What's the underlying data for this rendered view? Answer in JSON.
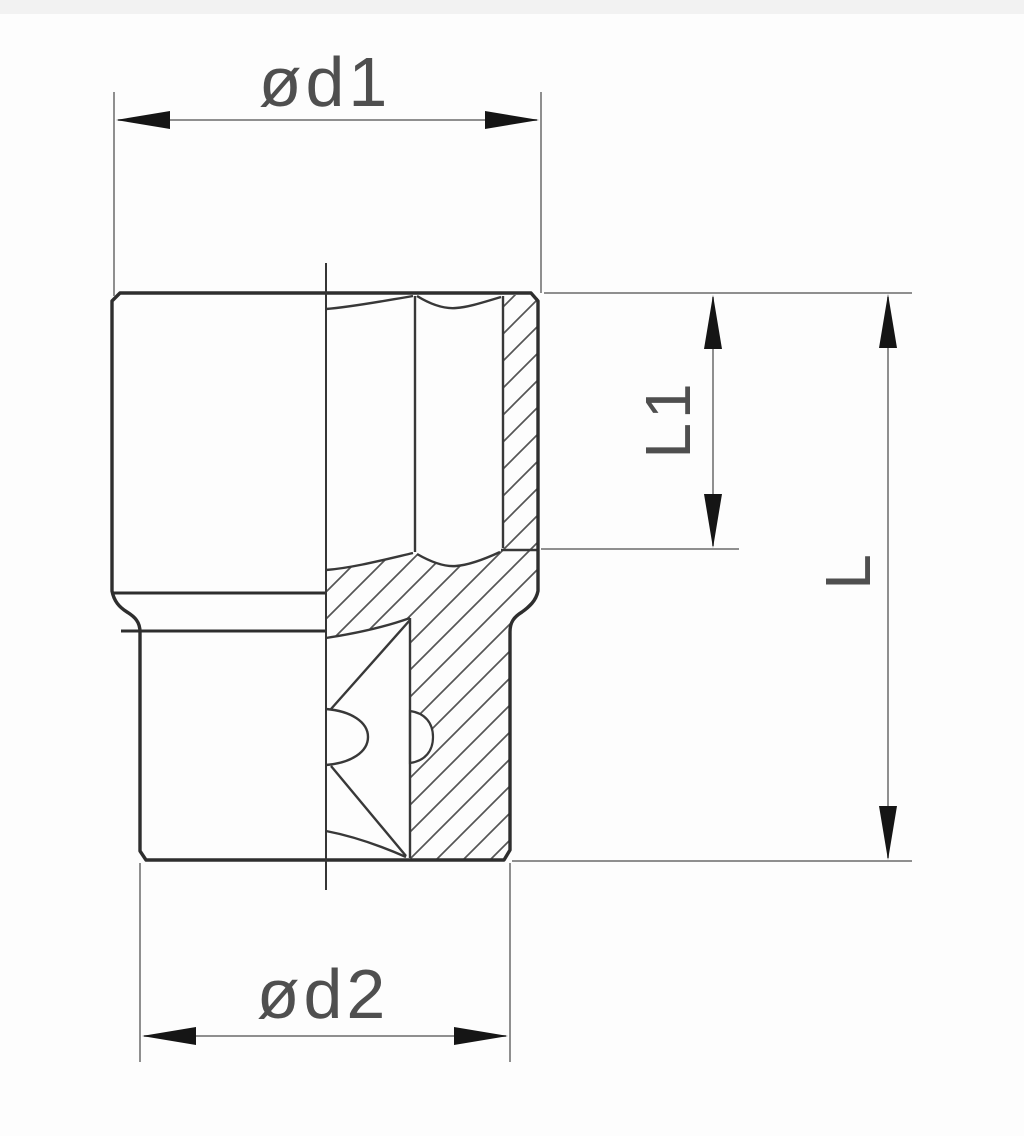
{
  "page": {
    "background": "#fdfdfd",
    "artifact_band_color": "#f2f2f2"
  },
  "drawing": {
    "view": "half-section",
    "colors": {
      "outline": "#2e2e2e",
      "edge": "#383838",
      "hatch": "#555555",
      "dimension_line": "#8f8f8f",
      "arrow": "#151515",
      "label_text": "#4f4f4f"
    },
    "labels": {
      "d1": "ød1",
      "d2": "ød2",
      "l1": "L1",
      "l": "L"
    }
  }
}
